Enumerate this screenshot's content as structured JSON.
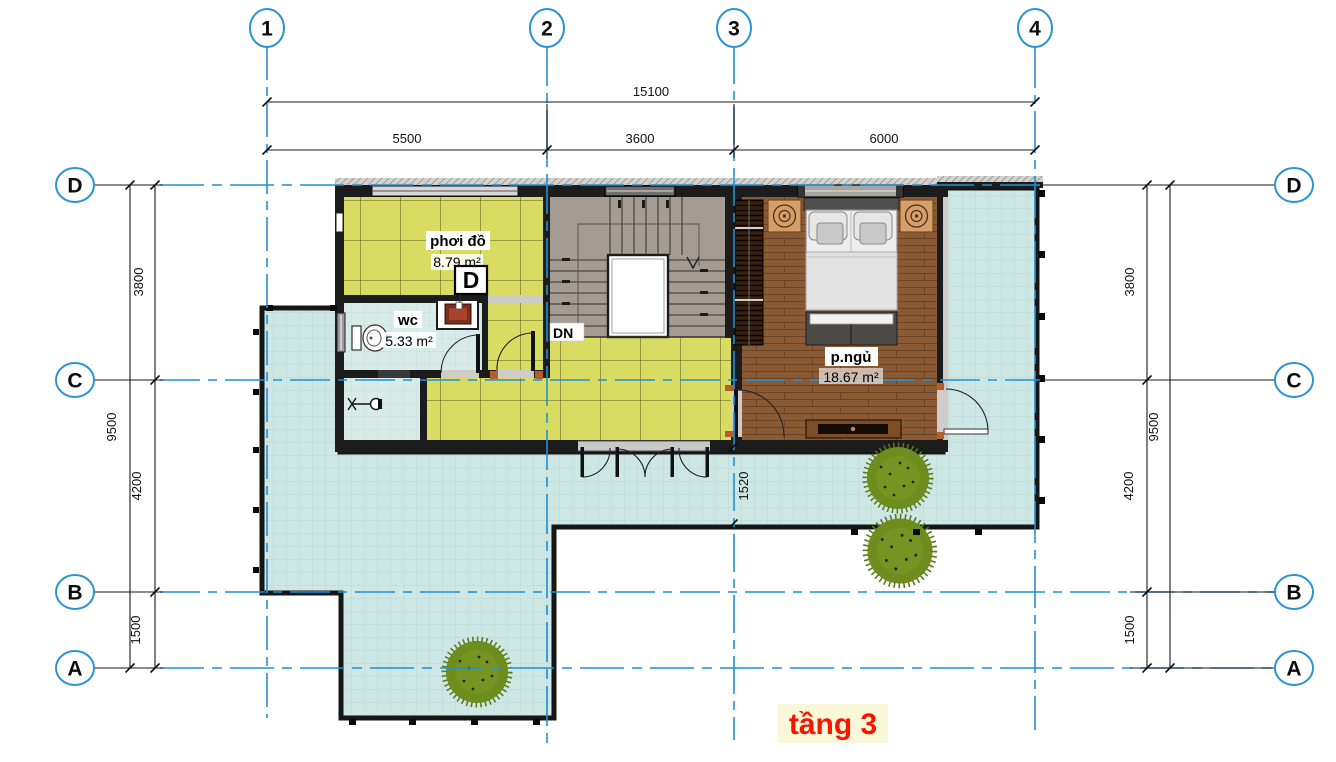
{
  "title": {
    "label": "tầng 3"
  },
  "grid": {
    "cols": [
      {
        "label": "1"
      },
      {
        "label": "2"
      },
      {
        "label": "3"
      },
      {
        "label": "4"
      }
    ],
    "rows": [
      {
        "label": "D"
      },
      {
        "label": "C"
      },
      {
        "label": "B"
      },
      {
        "label": "A"
      }
    ]
  },
  "dimensions": {
    "top_total": "15100",
    "top_segments": [
      "5500",
      "3600",
      "6000"
    ],
    "side_total": "9500",
    "side_segments": [
      "3800",
      "4200",
      "1500"
    ],
    "door_recess": "1520"
  },
  "rooms": [
    {
      "name": "phơi đồ",
      "area": "8.79 m²"
    },
    {
      "name": "wc",
      "area": "5.33 m²"
    },
    {
      "name": "p.ngủ",
      "area": "18.67 m²"
    }
  ],
  "stair": {
    "direction_label": "DN"
  },
  "section_marker": {
    "label": "D"
  },
  "colors": {
    "grid_blue": "#2191d2",
    "terrace_floor": "#cde7e5",
    "yellow_tile": "#d9dc62",
    "wc_floor": "#d7ebe9",
    "stair_floor": "#a49b92",
    "wood_floor": "#8a5a35",
    "wall_dark": "#1c1c1c",
    "title_red": "#fa1400",
    "title_bg": "#fbf8da",
    "tree_green": "#6f8d1e",
    "accent_jamb": "#b4602c"
  }
}
